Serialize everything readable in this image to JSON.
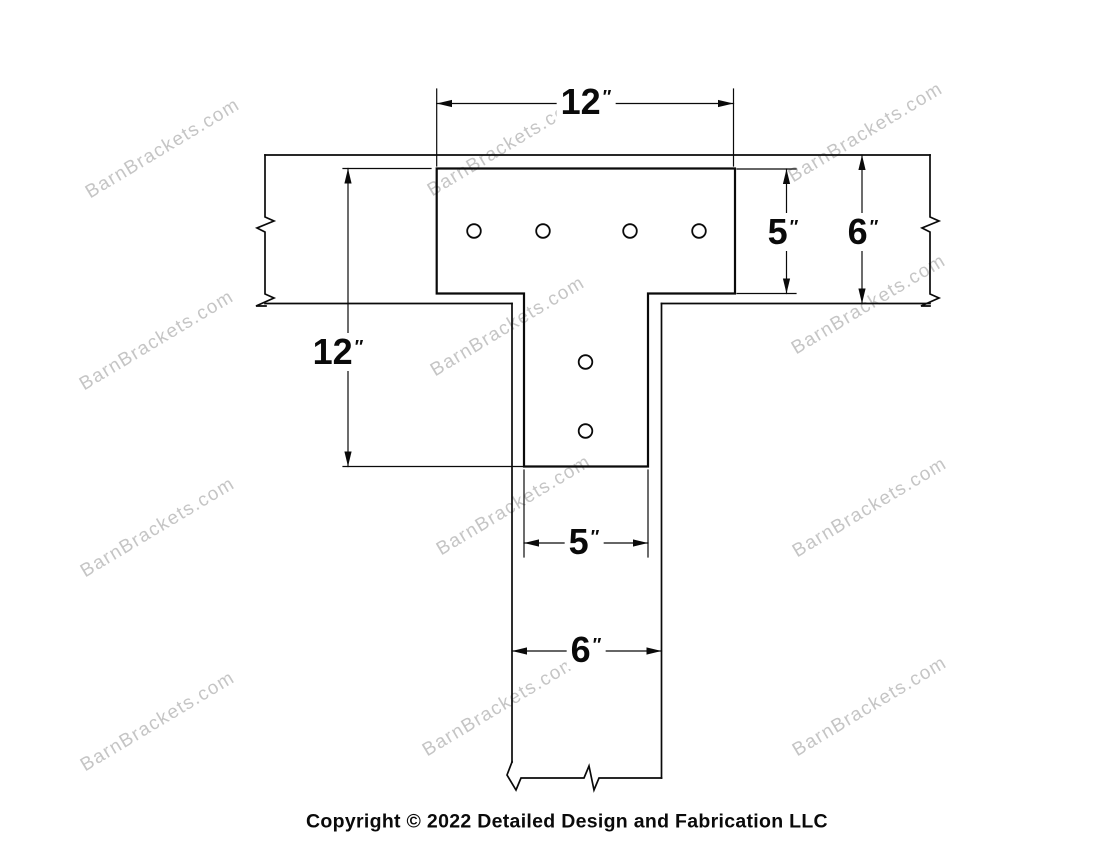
{
  "drawing": {
    "title_semantic": "T-shaped bracket technical drawing",
    "line_color": "#0a0a0a",
    "watermark": {
      "text": "BarnBrackets.com",
      "color": "#c5c5c5"
    },
    "dimensions": {
      "top_plate_width": {
        "value": "12",
        "unit": "″"
      },
      "top_plate_height": {
        "value": "5",
        "unit": "″"
      },
      "beam_depth": {
        "value": "6",
        "unit": "″"
      },
      "overall_height": {
        "value": "12",
        "unit": "″"
      },
      "stem_width": {
        "value": "5",
        "unit": "″"
      },
      "post_width": {
        "value": "6",
        "unit": "″"
      }
    },
    "bolt_holes": {
      "top_plate_count": 4,
      "stem_count": 2
    }
  },
  "footer": {
    "copyright_text": "Copyright © 2022 Detailed Design and Fabrication LLC"
  }
}
